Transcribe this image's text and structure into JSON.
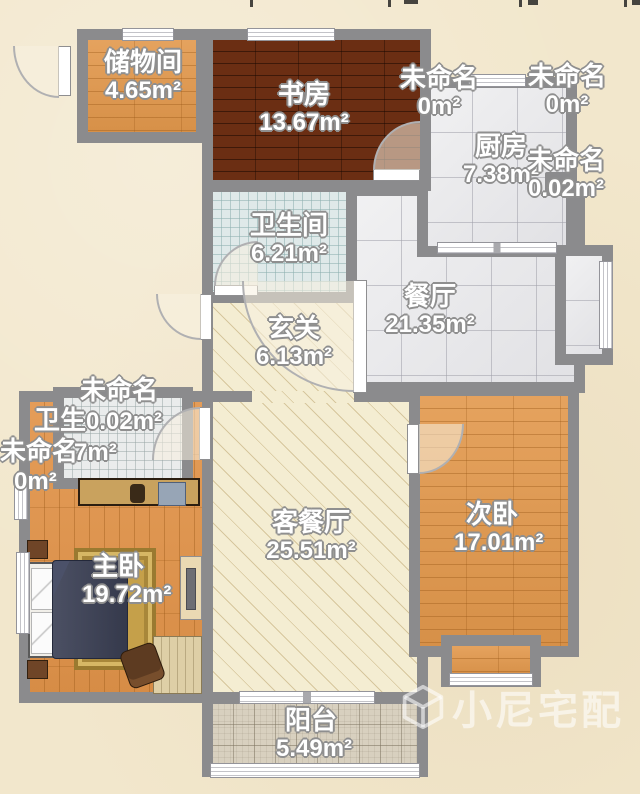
{
  "page": {
    "watermark": "小尼宅配"
  },
  "rooms": {
    "storage": {
      "name": "储物间",
      "area": "4.65m²"
    },
    "study": {
      "name": "书房",
      "area": "13.67m²"
    },
    "unnamed_top_left": {
      "name": "未命名",
      "area": "0m²"
    },
    "unnamed_top_right": {
      "name": "未命名",
      "area": "0m²"
    },
    "kitchen": {
      "name": "厨房",
      "area": "7.38m²"
    },
    "unnamed_kitchen": {
      "name": "未命名",
      "area": "0.02m²"
    },
    "bathroom_main": {
      "name": "卫生间",
      "area": "6.21m²"
    },
    "dining": {
      "name": "餐厅",
      "area": "21.35m²"
    },
    "entry": {
      "name": "玄关",
      "area": "6.13m²"
    },
    "unnamed_left": {
      "name": "未命名",
      "area": "0.02m²"
    },
    "bathroom_master": {
      "name": "卫生",
      "area": "7m²"
    },
    "unnamed_left2": {
      "name": "未命名",
      "area": "0m²"
    },
    "living": {
      "name": "客餐厅",
      "area": "25.51m²"
    },
    "master": {
      "name": "主卧",
      "area": "19.72m²"
    },
    "second": {
      "name": "次卧",
      "area": "17.01m²"
    },
    "balcony": {
      "name": "阳台",
      "area": "5.49m²"
    }
  },
  "colors": {
    "wall": "#8b8b8d",
    "background": "#f2e7cc",
    "wood_orange": "#e2984c",
    "wood_dark": "#6b2e13",
    "tile_gray": "#e9e9eb",
    "tile_blue": "#dfe9e9",
    "hatch_beige": "#f4edd2",
    "balcony_tile": "#d8d0bf",
    "label_text": "#ffffff"
  }
}
